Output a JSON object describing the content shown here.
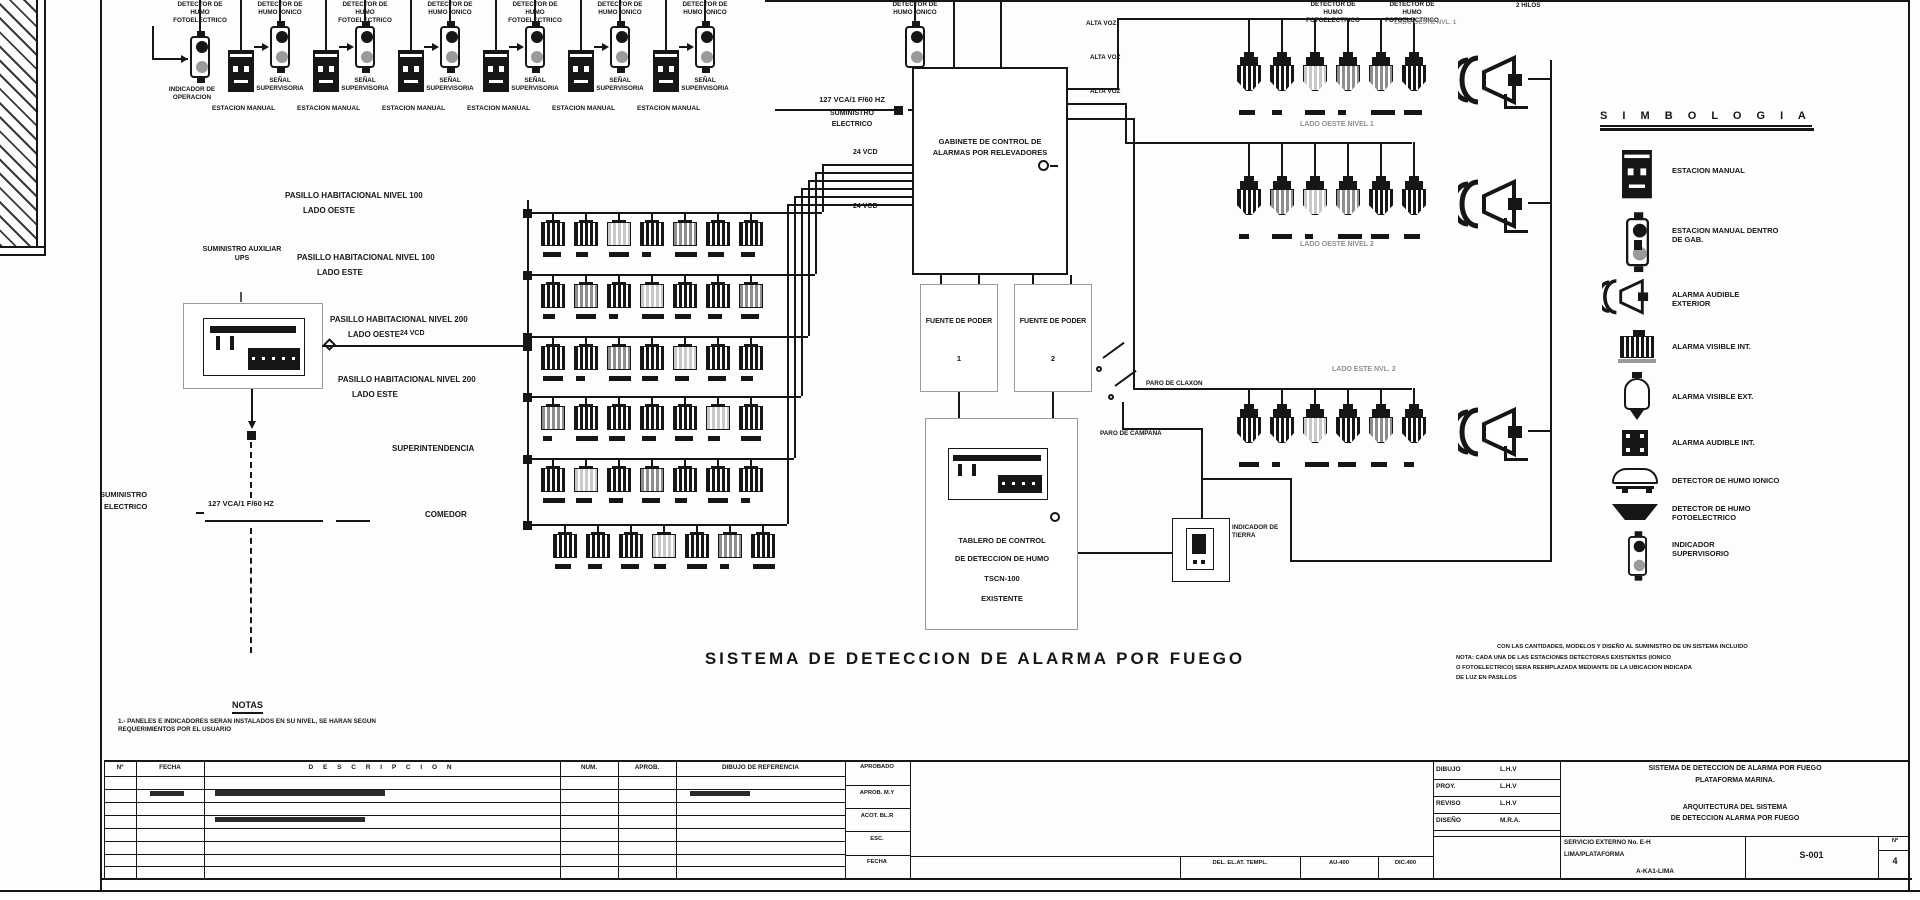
{
  "page": {
    "bg": "#fdfdfd",
    "ink": "#161616",
    "gray": "#8f8f8f"
  },
  "title": "SISTEMA DE DETECCION DE ALARMA POR FUEGO",
  "top": {
    "detectors": [
      "DETECTOR DE HUMO FOTOELECTRICO",
      "DETECTOR DE HUMO IONICO",
      "DETECTOR DE HUMO FOTOELECTRICO",
      "DETECTOR DE HUMO IONICO",
      "DETECTOR DE HUMO FOTOELECTRICO",
      "DETECTOR DE HUMO IONICO",
      "DETECTOR DE HUMO IONICO",
      "DETECTOR DE HUMO IONICO"
    ],
    "indicador": "INDICADOR DE OPERACION",
    "senal": "SEÑAL SUPERVISORIA",
    "estacion": "ESTACION MANUAL",
    "supply_value": "127 VCA/1 F/60 HZ",
    "supply_l1": "SUMINISTRO",
    "supply_l2": "ELECTRICO",
    "vcd": "24 VCD",
    "alta_voz": "ALTA VOZ",
    "cut_detector": "DETECTOR DE HUMO FOTOELECTRICO",
    "cut_hilos": "2 HILOS"
  },
  "left": {
    "ups": "SUMINISTRO AUXILIAR UPS",
    "vcd": "24 VCD",
    "rows": [
      {
        "l1": "PASILLO HABITACIONAL NIVEL 100",
        "l2": "LADO OESTE"
      },
      {
        "l1": "PASILLO HABITACIONAL NIVEL 100",
        "l2": "LADO ESTE"
      },
      {
        "l1": "PASILLO HABITACIONAL NIVEL 200",
        "l2": "LADO OESTE"
      },
      {
        "l1": "PASILLO HABITACIONAL NIVEL 200",
        "l2": "LADO ESTE"
      },
      {
        "l1": "SUPERINTENDENCIA",
        "l2": ""
      },
      {
        "l1": "COMEDOR",
        "l2": ""
      }
    ],
    "supply_l1": "SUMINISTRO",
    "supply_l2": "ELECTRICO",
    "supply_value": "127 VCA/1 F/60 HZ"
  },
  "center": {
    "cabinet": "GABINETE DE CONTROL DE ALARMAS POR RELEVADORES",
    "fuente": "FUENTE DE PODER",
    "fuente1_no": "1",
    "fuente2_no": "2",
    "claxon": "PARO DE CLAXON",
    "campana": "PARO DE CAMPANA",
    "tablero_l1": "TABLERO DE CONTROL",
    "tablero_l2": "DE DETECCION DE HUMO",
    "tablero_l3": "TSCN-100",
    "tablero_l4": "EXISTENTE",
    "tierra": "INDICADOR DE TIERRA"
  },
  "right": {
    "g1_top": "LADO OESTE NVL. 1",
    "g1": "LADO OESTE NIVEL 1",
    "g2": "LADO OESTE NIVEL 2",
    "g3": "LADO ESTE NVL. 2"
  },
  "legend": {
    "title": "S I M B O L O G I A",
    "items": [
      "ESTACION MANUAL",
      "ESTACION MANUAL DENTRO DE GAB.",
      "ALARMA AUDIBLE EXTERIOR",
      "ALARMA VISIBLE INT.",
      "ALARMA VISIBLE EXT.",
      "ALARMA AUDIBLE INT.",
      "DETECTOR DE HUMO IONICO",
      "DETECTOR DE HUMO FOTOELECTRICO",
      "INDICADOR SUPERVISORIO"
    ]
  },
  "notes": {
    "title": "NOTAS",
    "body": "1.- PANELES E INDICADORES SERAN INSTALADOS EN SU NIVEL, SE HARAN SEGUN REQUERIMIENTOS POR EL USUARIO",
    "right_l1": "CON LAS CANTIDADES, MODELOS Y DISEÑO AL SUMINISTRO DE UN SISTEMA INCLUIDO",
    "right_l2": "NOTA: CADA UNA DE LAS ESTACIONES DETECTORAS EXISTENTES (IONICO",
    "right_l3": "O FOTOELECTRICO) SERA REEMPLAZADA MEDIANTE DE LA UBICACION INDICADA",
    "right_l4": "DE LUZ EN PASILLOS"
  },
  "titleblock": {
    "headers": {
      "no": "Nº",
      "fecha": "FECHA",
      "desc": "D  E  S  C  R  I  P  C  I  O  N",
      "num": "NUM.",
      "aprob": "APROB.",
      "ref": "DIBUJO DE REFERENCIA",
      "aprobado": "APROBADO"
    },
    "stamps": [
      {
        "k": "DIBUJO",
        "v": "L.H.V"
      },
      {
        "k": "PROY.",
        "v": "L.H.V"
      },
      {
        "k": "REVISO",
        "v": "L.H.V"
      },
      {
        "k": "DISEÑO",
        "v": "M.R.A."
      }
    ],
    "mid": [
      "APROB. M.Y",
      "ACOT. BL.R",
      "ESC.",
      "FECHA"
    ],
    "bottom": [
      "DEL. EL.AT. TEMPL.",
      "AU-400",
      "DIC.400"
    ],
    "project_l1": "SISTEMA DE DETECCION DE ALARMA POR FUEGO",
    "project_l2": "PLATAFORMA MARINA.",
    "subtitle_l1": "ARQUITECTURA DEL SISTEMA",
    "subtitle_l2": "DE DETECCION ALARMA POR FUEGO",
    "service_l1": "SERVICIO EXTERNO No. E-H",
    "service_l2": "LIMA/PLATAFORMA",
    "service_l3": "A-KA1-LIMA",
    "drawing_no": "S-001",
    "sheet_label": "Nº",
    "sheet_no": "4"
  }
}
